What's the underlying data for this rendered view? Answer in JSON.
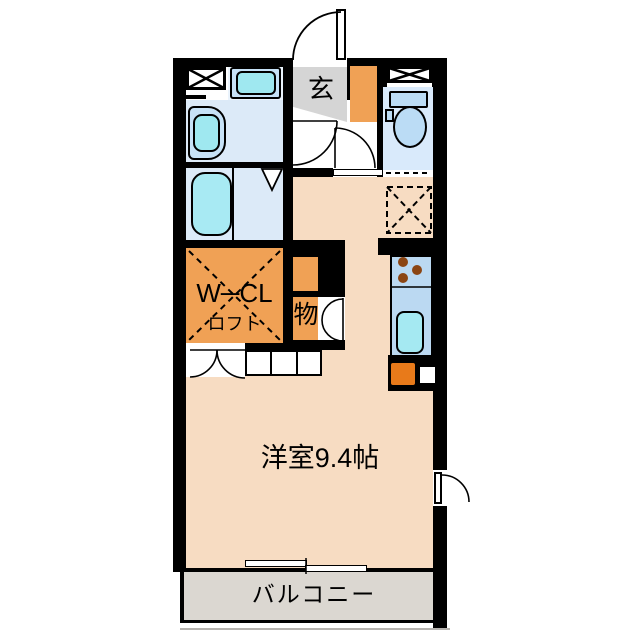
{
  "floorplan": {
    "type": "apartment-floor-plan",
    "rooms": {
      "entrance": {
        "label": "玄"
      },
      "walk_in_closet": {
        "label": "W─CL",
        "sub_label": "ロフト"
      },
      "storage": {
        "label": "物"
      },
      "main_room": {
        "label": "洋室9.4帖"
      },
      "balcony": {
        "label": "バルコニー"
      }
    },
    "colors": {
      "wall": "#000000",
      "room_floor": "#F7DCC2",
      "closet_orange": "#F0A155",
      "entrance_gray": "#D5D5D5",
      "balcony_gray": "#DBD7D1",
      "wet_area_blue": "#DCEAF8",
      "fixture_blue": "#BBDCF5",
      "water_cyan": "#A8EAF3",
      "kitchen_counter_blue": "#BBD9F2",
      "appliance_orange": "#E87A1A",
      "burner_brown": "#8B4513"
    }
  }
}
